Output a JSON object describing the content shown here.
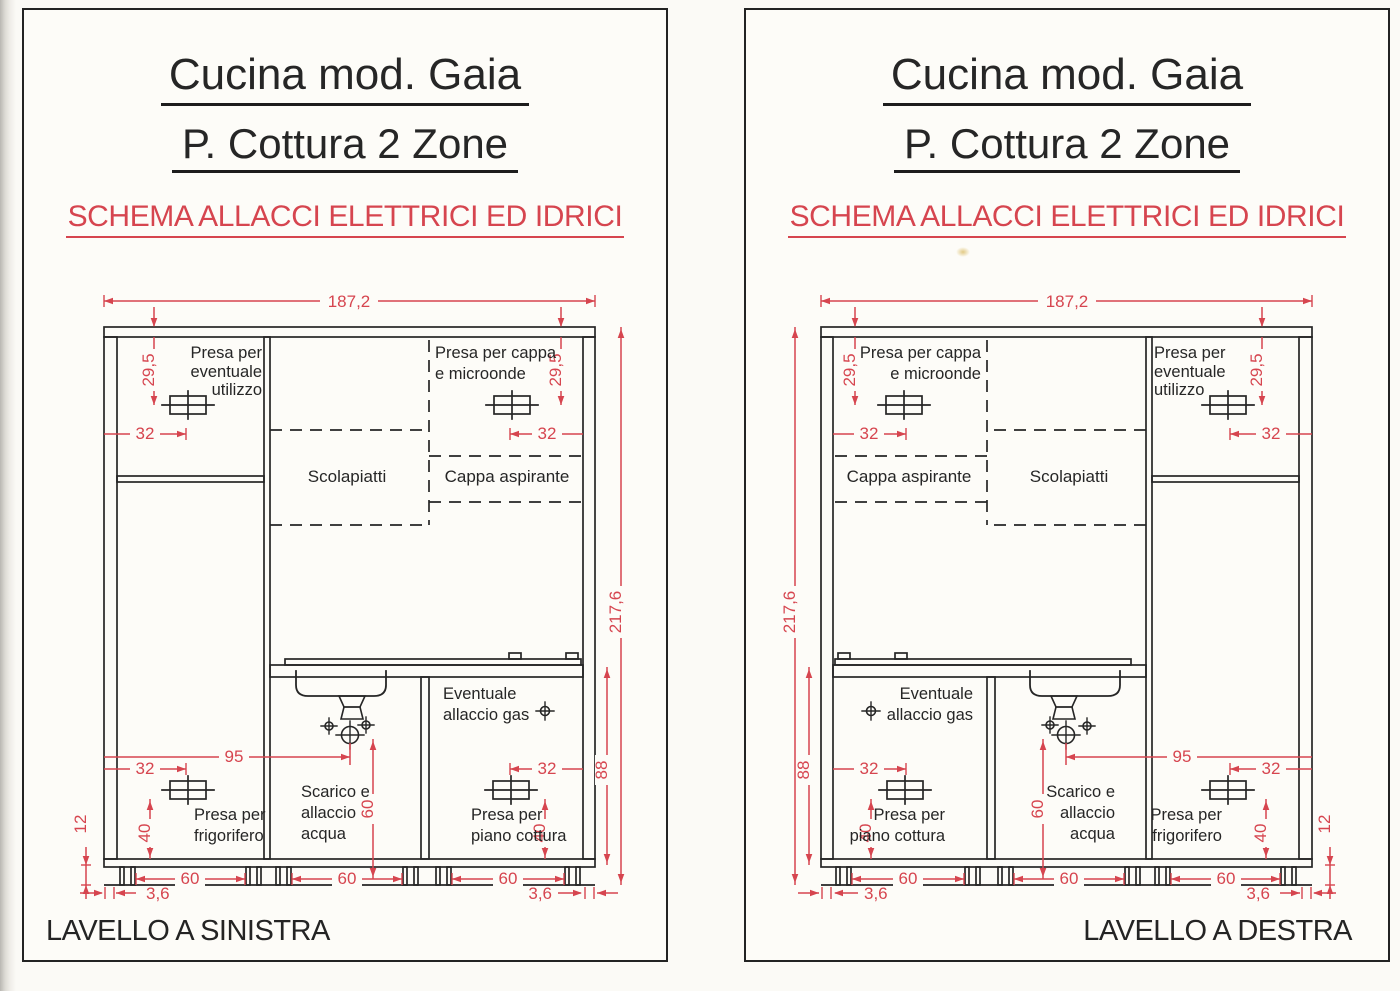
{
  "colors": {
    "ink": "#262626",
    "dim_red": "#d6454f",
    "paper": "#fdfcf8"
  },
  "panels": [
    {
      "title": "Cucina mod. Gaia",
      "subtitle": "P. Cottura 2 Zone",
      "schema_heading": "SCHEMA ALLACCI ELETTRICI ED IDRICI",
      "footer": "LAVELLO A SINISTRA"
    },
    {
      "title": "Cucina mod. Gaia",
      "subtitle": "P. Cottura 2 Zone",
      "schema_heading": "SCHEMA ALLACCI ELETTRICI ED IDRICI",
      "footer": "LAVELLO A DESTRA"
    }
  ],
  "drawing": {
    "dimensions": {
      "total_width": "187,2",
      "total_height": "217,6",
      "top_socket_drop": "29,5",
      "socket_side_offset": "32",
      "drain_from_wall": "95",
      "drain_height": "60",
      "base_height": "88",
      "bottom_socket_height": "40",
      "plinth_height": "12",
      "base_unit_width": "60",
      "leg_inset": "3,6"
    },
    "labels": {
      "presa_eventuale": [
        "Presa per",
        "eventuale",
        "utilizzo"
      ],
      "presa_cappa": [
        "Presa per cappa",
        "e microonde"
      ],
      "scolapiatti": "Scolapiatti",
      "cappa_aspirante": "Cappa aspirante",
      "eventuale_gas": [
        "Eventuale",
        "allaccio gas"
      ],
      "scarico_acqua": [
        "Scarico e",
        "allaccio",
        "acqua"
      ],
      "presa_frigorifero": [
        "Presa per",
        "frigorifero"
      ],
      "presa_piano_cottura": [
        "Presa per",
        "piano cottura"
      ]
    }
  }
}
